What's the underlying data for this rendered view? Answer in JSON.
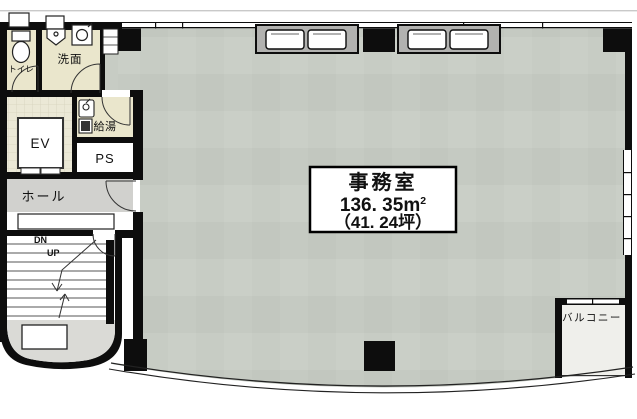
{
  "floorplan": {
    "rooms": {
      "toilet": "トイレ",
      "washroom": "洗面",
      "elevator": "EV",
      "hot_water": "給湯",
      "pipe_space": "PS",
      "hall": "ホール",
      "balcony": "バルコニー"
    },
    "stairs": {
      "down": "DN",
      "up": "UP"
    },
    "office": {
      "name": "事務室",
      "area_value": "136. 35m",
      "area_sup": "2",
      "area_tsubo": "（41. 24坪）"
    },
    "colors": {
      "wall": "#0d0d0d",
      "office_floor": "#c7ccc4",
      "service_beige": "#eae6cc",
      "service_tile": "#ebe8d6",
      "hall_gray": "#d1d1ce",
      "stair_gray": "#dadad6",
      "balcony_floor": "#efefeb",
      "panel_gray": "#b2b2b0"
    }
  }
}
